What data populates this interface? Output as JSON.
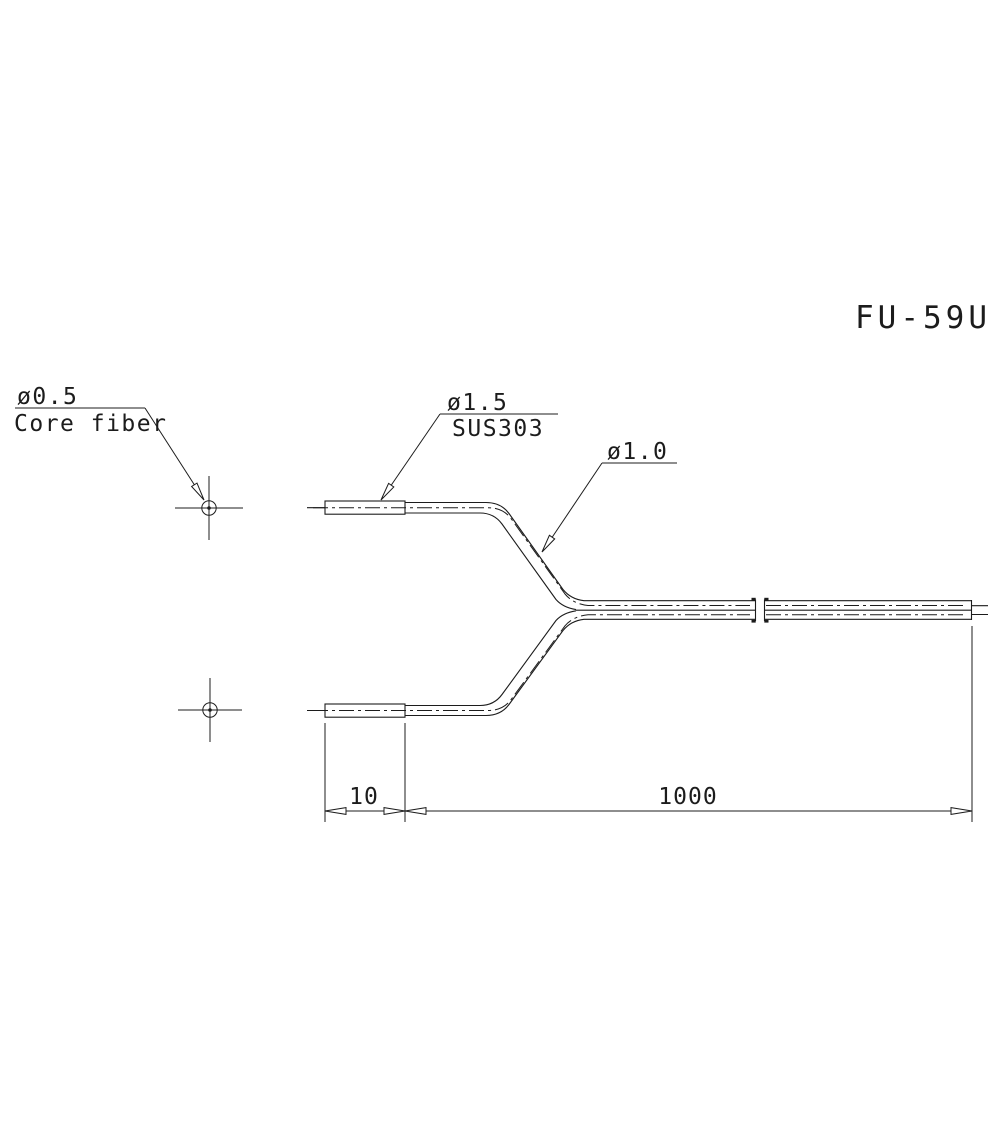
{
  "drawing": {
    "title": "FU-59U",
    "callouts": {
      "core_fiber": {
        "diameter": "ø0.5",
        "name": "Core fiber"
      },
      "sleeve": {
        "diameter": "ø1.5",
        "material": "SUS303"
      },
      "cable": {
        "diameter": "ø1.0"
      }
    },
    "dimensions": {
      "sleeve_length": "10",
      "cable_length": "1000"
    },
    "colors": {
      "line": "#1c1c1c",
      "background": "#ffffff"
    }
  }
}
